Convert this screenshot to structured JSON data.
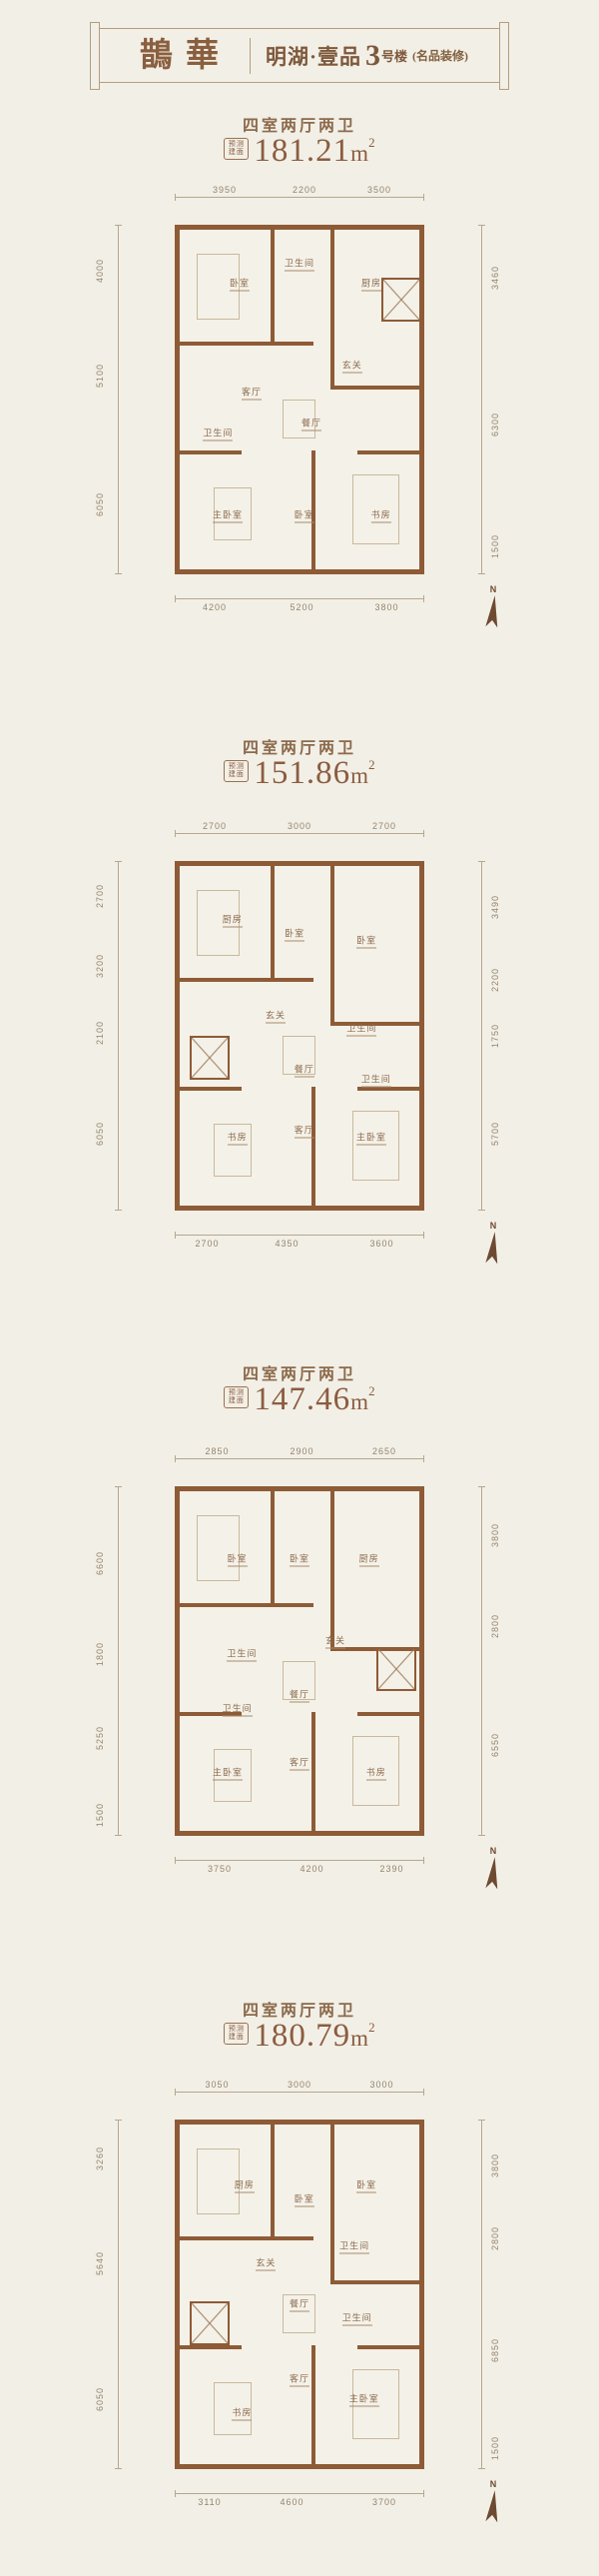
{
  "colors": {
    "background": "#f2efe6",
    "wall_brown": "#8e5b37",
    "text_brown": "#8b5c40",
    "header_border": "#b49d7f"
  },
  "header": {
    "logo": "鵲華",
    "project": "明湖·壹品",
    "building_number": "3",
    "building_suffix": "号楼",
    "note": "(名品装修)"
  },
  "labels": {
    "area_prefix_line1": "预测",
    "area_prefix_line2": "建面",
    "north": "N"
  },
  "plans": [
    {
      "layout": "四室两厅两卫",
      "area_value": "181.21",
      "area_unit": "m",
      "area_exp": "2",
      "dims": {
        "top": [
          "3950",
          "2200",
          "3500"
        ],
        "left": [
          "4000",
          "5100",
          "6050"
        ],
        "right": [
          "3460",
          "6300",
          "1500"
        ],
        "bottom": [
          "4200",
          "5200",
          "3800"
        ]
      },
      "rooms": [
        "卧室",
        "卫生间",
        "厨房",
        "玄关",
        "客厅",
        "餐厅",
        "卫生间",
        "主卧室",
        "卧室",
        "书房"
      ]
    },
    {
      "layout": "四室两厅两卫",
      "area_value": "151.86",
      "area_unit": "m",
      "area_exp": "2",
      "dims": {
        "top": [
          "2700",
          "3000",
          "2700"
        ],
        "left": [
          "2700",
          "3200",
          "2100",
          "6050"
        ],
        "right": [
          "3490",
          "2200",
          "1750",
          "5700"
        ],
        "bottom": [
          "2700",
          "4350",
          "3600"
        ]
      },
      "rooms": [
        "厨房",
        "卧室",
        "卧室",
        "玄关",
        "卫生间",
        "餐厅",
        "卫生间",
        "书房",
        "客厅",
        "主卧室"
      ]
    },
    {
      "layout": "四室两厅两卫",
      "area_value": "147.46",
      "area_unit": "m",
      "area_exp": "2",
      "dims": {
        "top": [
          "2850",
          "2900",
          "2650"
        ],
        "left": [
          "6600",
          "1800",
          "5250",
          "1500"
        ],
        "right": [
          "3800",
          "2800",
          "6550"
        ],
        "bottom": [
          "3750",
          "4200",
          "2390"
        ]
      },
      "rooms": [
        "卧室",
        "卧室",
        "厨房",
        "卫生间",
        "玄关",
        "餐厅",
        "卫生间",
        "主卧室",
        "客厅",
        "书房"
      ]
    },
    {
      "layout": "四室两厅两卫",
      "area_value": "180.79",
      "area_unit": "m",
      "area_exp": "2",
      "dims": {
        "top": [
          "3050",
          "3000",
          "3000"
        ],
        "left": [
          "3260",
          "5640",
          "6050"
        ],
        "right": [
          "3800",
          "2800",
          "6850",
          "1500"
        ],
        "bottom": [
          "3110",
          "4600",
          "3700"
        ]
      },
      "rooms": [
        "厨房",
        "卧室",
        "卧室",
        "卫生间",
        "玄关",
        "餐厅",
        "卫生间",
        "书房",
        "客厅",
        "主卧室"
      ]
    }
  ]
}
